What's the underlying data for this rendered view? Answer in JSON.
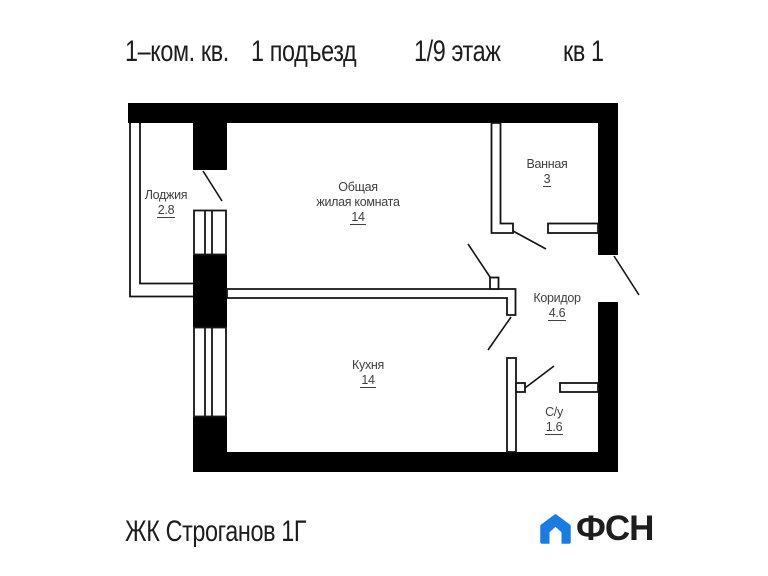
{
  "header": {
    "apartment_type": "1–ком. кв.",
    "entrance": "1 подъезд",
    "floor": "1/9 этаж",
    "unit": "кв 1"
  },
  "rooms": {
    "loggia": {
      "name": "Лоджия",
      "area": "2.8"
    },
    "living": {
      "name_line1": "Общая",
      "name_line2": "жилая комната",
      "area": "14"
    },
    "bathroom": {
      "name": "Ванная",
      "area": "3"
    },
    "corridor": {
      "name": "Коридор",
      "area": "4.6"
    },
    "kitchen": {
      "name": "Кухня",
      "area": "14"
    },
    "wc": {
      "name": "С/у",
      "area": "1.6"
    }
  },
  "footer": {
    "project": "ЖК Строганов 1Г",
    "logo": {
      "text": "ФСН",
      "icon": "house",
      "icon_color": "#1a7ce0",
      "text_color": "#1e1e1e"
    }
  },
  "colors": {
    "walls": "#000000",
    "lines": "#141414",
    "label_text": "#404040",
    "heading_text": "#1d1d1d"
  }
}
